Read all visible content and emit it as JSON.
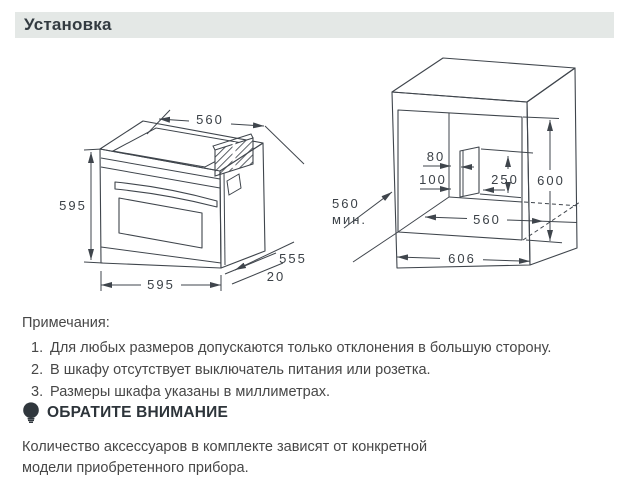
{
  "header": {
    "title": "Установка"
  },
  "oven_diagram": {
    "dims": {
      "top_depth": "560",
      "height": "595",
      "width": "595",
      "side_depth": "555",
      "overhang": "20"
    }
  },
  "cabinet_diagram": {
    "dims": {
      "hole_offset_a": "80",
      "hole_offset_b": "100",
      "hole_height": "250",
      "niche_height": "600",
      "niche_width": "560",
      "min_depth": "560",
      "min_depth_unit": "мин.",
      "outer_width": "606"
    }
  },
  "notes": {
    "heading": "Примечания:",
    "items": [
      {
        "num": "1.",
        "text": "Для любых размеров допускаются только отклонения в большую сторону."
      },
      {
        "num": "2.",
        "text": "В шкафу отсутствует выключатель питания или розетка."
      },
      {
        "num": "3.",
        "text": "Размеры шкафа указаны в миллиметрах."
      }
    ]
  },
  "attention": {
    "heading": "ОБРАТИТЕ ВНИМАНИЕ",
    "text": "Количество аксессуаров в комплекте зависят от конкретной модели приобретенного прибора."
  },
  "colors": {
    "header_bg": "#e4e8e6",
    "line": "#3f454c",
    "body_text": "#474747",
    "heading_text": "#2d343a"
  }
}
